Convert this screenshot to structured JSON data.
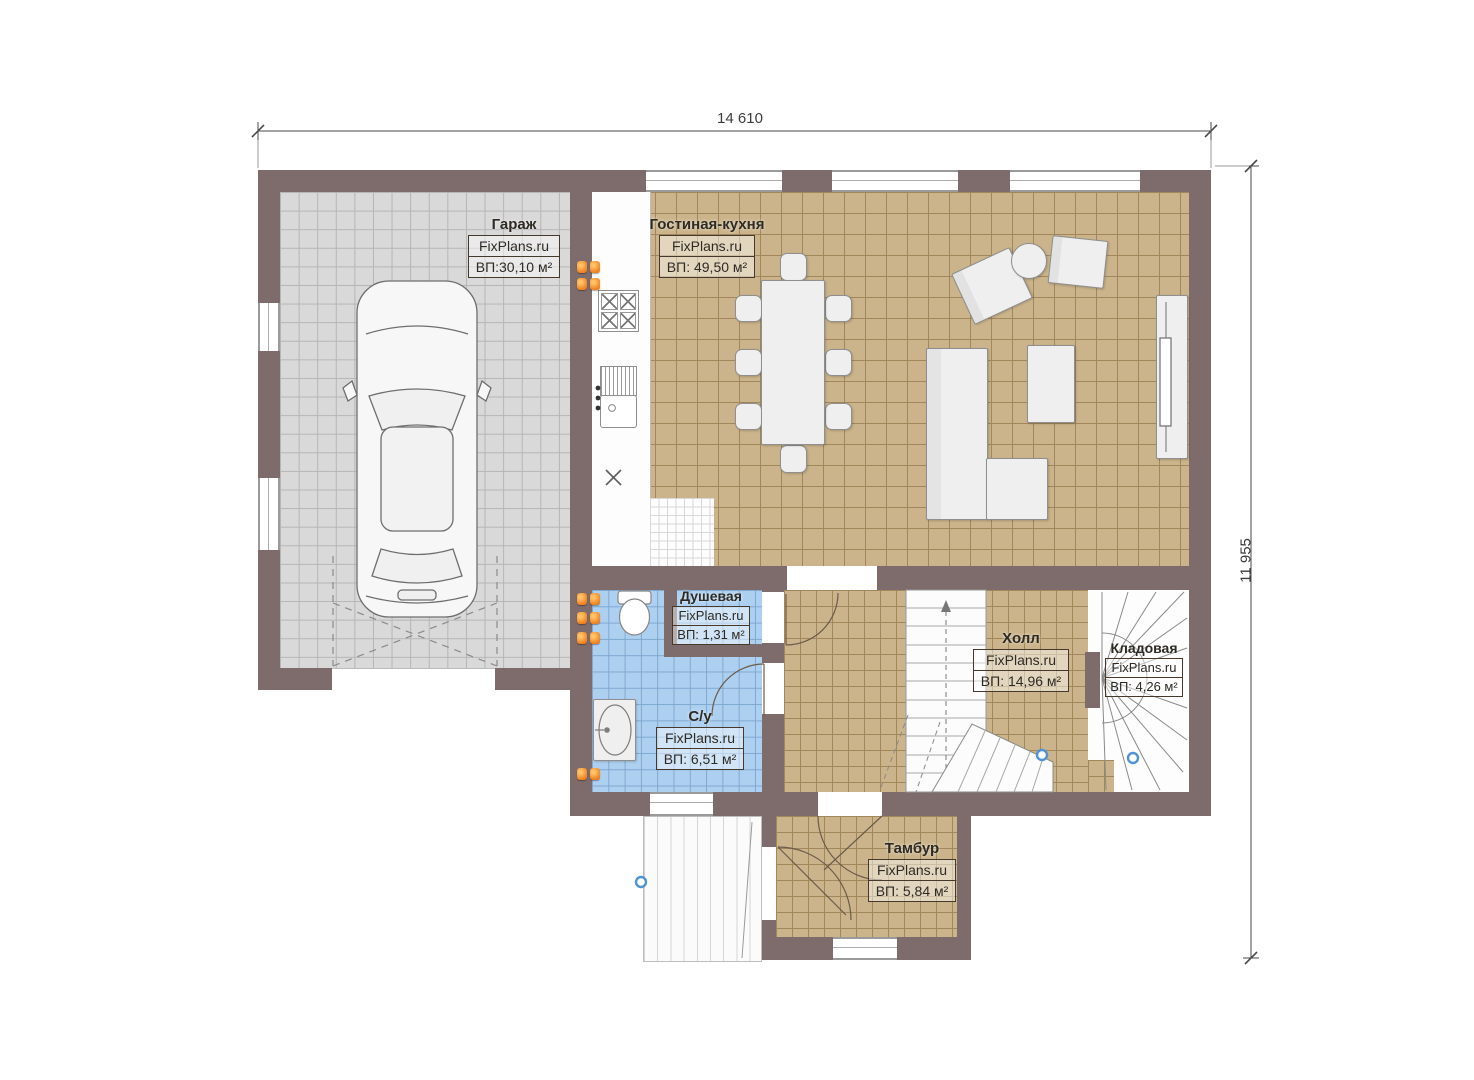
{
  "plan_title": "First floor plan",
  "watermark": "FixPlans.ru",
  "dimensions": {
    "top": "14 610",
    "right": "11 955"
  },
  "rooms": {
    "garage": {
      "name": "Гараж",
      "site": "FixPlans.ru",
      "area": "ВП:30,10 м²"
    },
    "living": {
      "name": "Гостиная-кухня",
      "site": "FixPlans.ru",
      "area": "ВП: 49,50 м²"
    },
    "shower": {
      "name": "Душевая",
      "site": "FixPlans.ru",
      "area": "ВП: 1,31 м²"
    },
    "wc": {
      "name": "С/у",
      "site": "FixPlans.ru",
      "area": "ВП: 6,51 м²"
    },
    "hall": {
      "name": "Холл",
      "site": "FixPlans.ru",
      "area": "ВП: 14,96 м²"
    },
    "storage": {
      "name": "Кладовая",
      "site": "FixPlans.ru",
      "area": "ВП: 4,26 м²"
    },
    "tambour": {
      "name": "Тамбур",
      "site": "FixPlans.ru",
      "area": "ВП: 5,84 м²"
    }
  },
  "colors": {
    "wall": "#7e6c6c",
    "floor_tan": "#cbb48b",
    "floor_grey": "#d9d9d9",
    "floor_blue": "#aed0f0",
    "radiator": "#ee7f1c",
    "marker": "#4f93d4"
  }
}
